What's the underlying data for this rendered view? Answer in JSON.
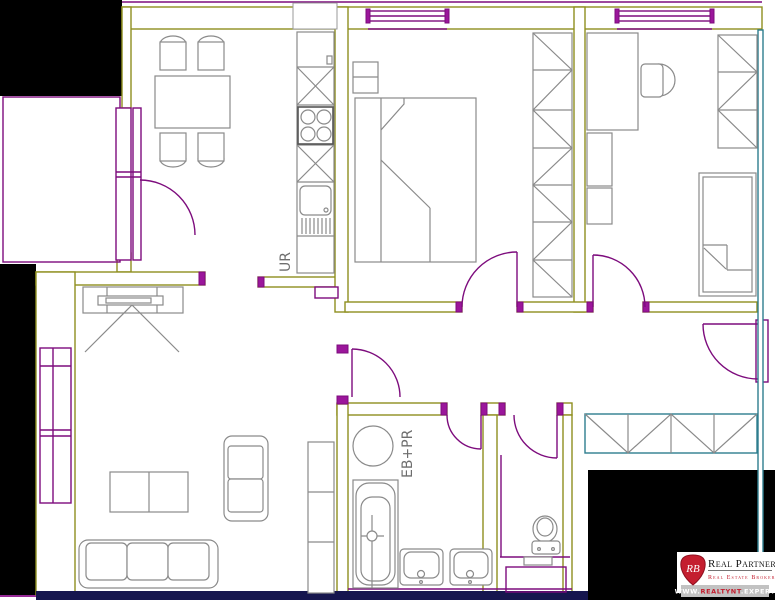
{
  "colors": {
    "wall_olive": "#8F8F1E",
    "fixture_purple": "#7D0C7D",
    "window_magenta": "#C837C8",
    "right_wall_teal": "#2E7D8E",
    "bottom_wall_navy": "#16164E",
    "furniture_gray": "#8A8A8A",
    "outside_black": "#000000",
    "label_gray": "#6E6E6E",
    "logo_red": "#C41E2F",
    "logo_bar_gray": "#C2C2C2"
  },
  "floorplan": {
    "labels": {
      "kitchen_unit": "UR",
      "bath_unit": "EB+PR"
    }
  },
  "logo": {
    "monogram": "RB",
    "name": "Real Partners",
    "tagline": "Real Estate Brokerage",
    "website_prefix": "WWW.",
    "website_domain": "REALTYNT",
    "website_tld": ".EXPERT"
  }
}
